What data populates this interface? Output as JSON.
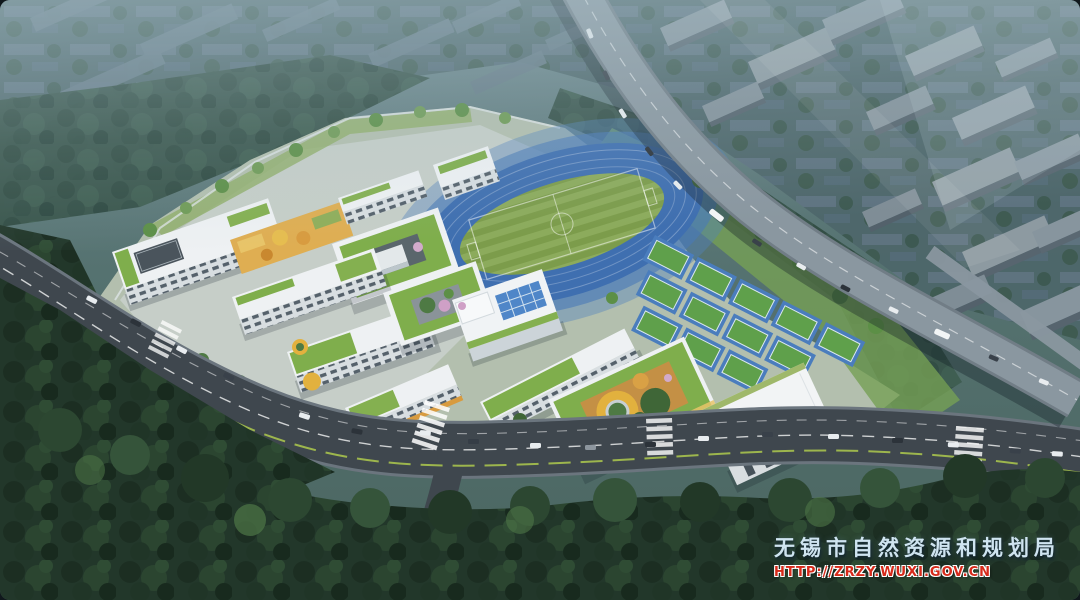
{
  "watermark": {
    "agency": "无锡市自然资源和规划局",
    "url": "HTTP://ZRZY.WUXI.GOV.CN",
    "agency_color": "#cfe4f0",
    "url_color": "#d62a1a"
  },
  "palette": {
    "haze_top": "#7f99a2",
    "city_base": "#4d666a",
    "city_building": "#68808c",
    "distant_tree": "#375349",
    "track_blue": "#3f6fb0",
    "track_apron": "#5181bd",
    "field_green_light": "#8cab5c",
    "field_green_dark": "#7c9c4b",
    "court_green": "#5fa04b",
    "court_blue": "#4a7dbd",
    "roof_green": "#7fae4c",
    "terrace_yellow": "#dfae52",
    "building_white": "#eef1f3",
    "building_face": "#d8dee1",
    "pool_blue": "#4f86c8",
    "play_yellow": "#e2b13e",
    "play_orange": "#c49045",
    "road_asphalt": "#3f474e",
    "highway_deck": "#8a97a0",
    "lawn_green": "#76a055",
    "tree_green": "#54824a",
    "forest_dark": "#1f3125",
    "blossom_pink": "#cfa0c6"
  }
}
